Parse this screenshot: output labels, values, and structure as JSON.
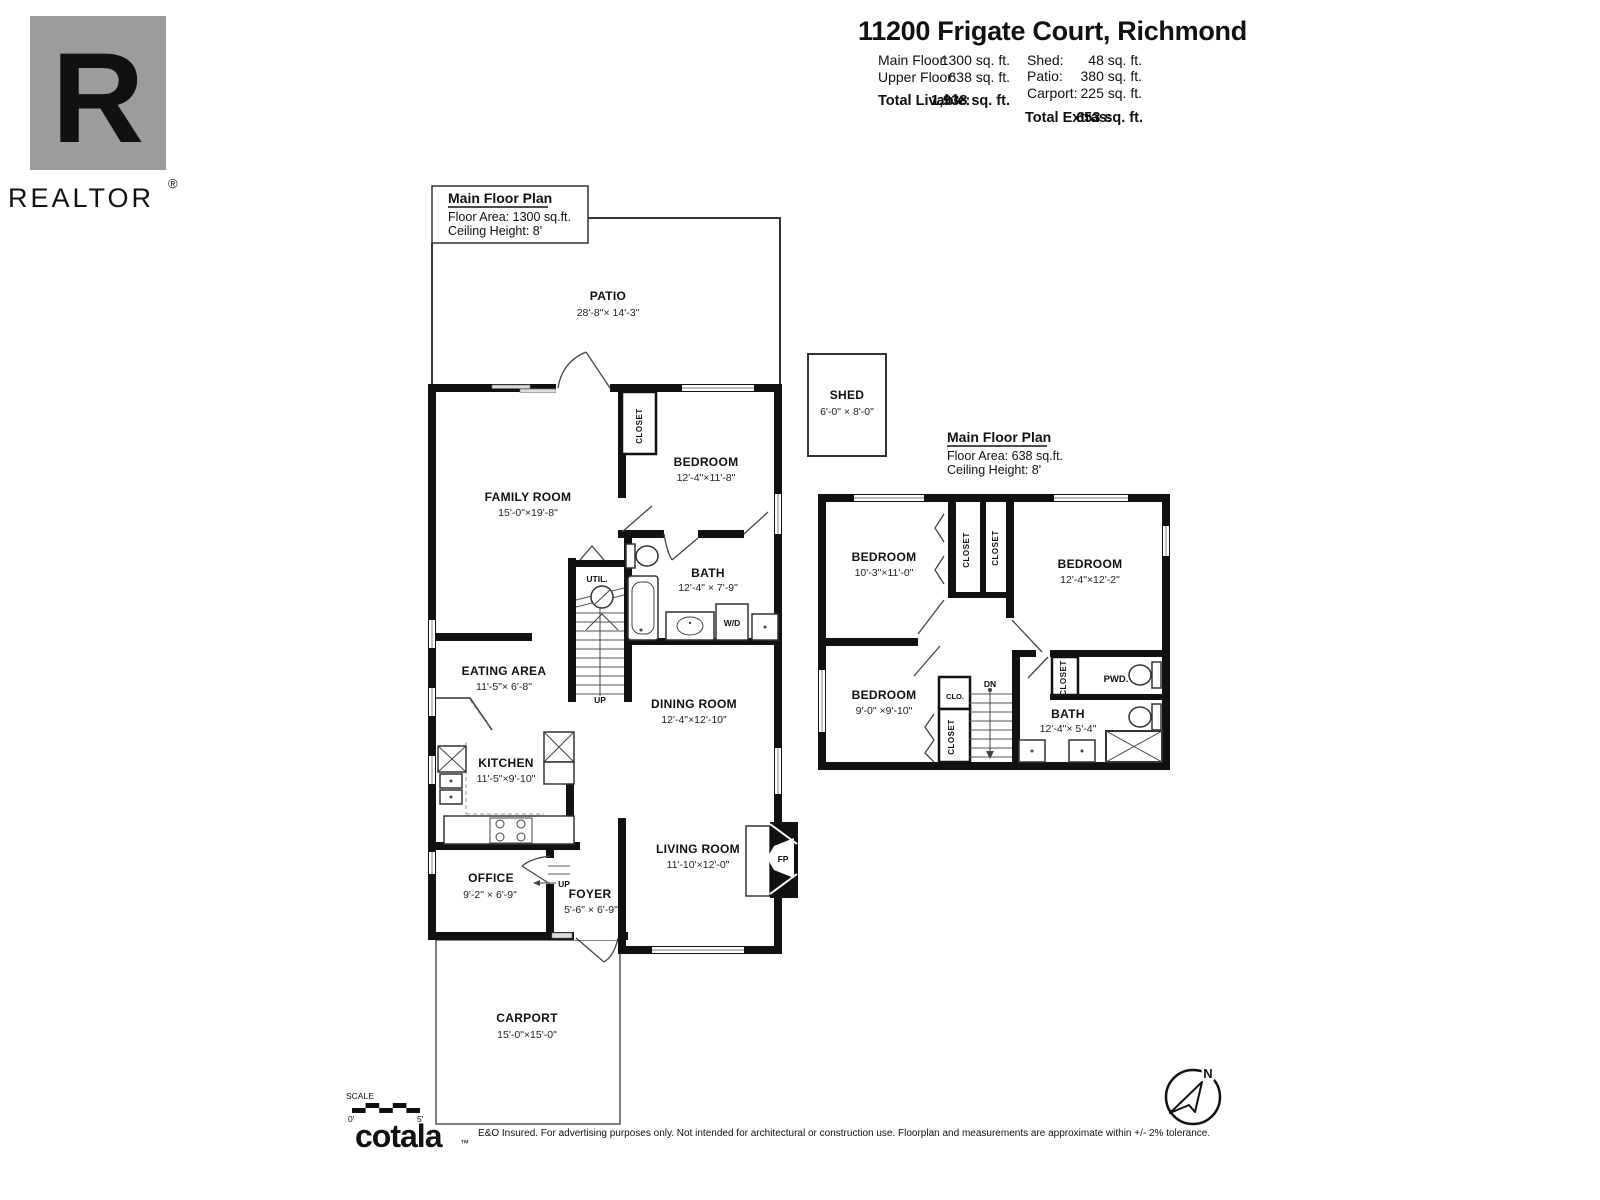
{
  "header": {
    "title": "11200 Frigate Court, Richmond",
    "stats_left": [
      {
        "label": "Main Floor:",
        "value": "1300 sq. ft."
      },
      {
        "label": "Upper Floor:",
        "value": "638 sq. ft."
      }
    ],
    "total_livable": {
      "label": "Total Livable:",
      "value": "1,938 sq. ft."
    },
    "stats_right": [
      {
        "label": "Shed:",
        "value": "48 sq. ft."
      },
      {
        "label": "Patio:",
        "value": "380 sq. ft."
      },
      {
        "label": "Carport:",
        "value": "225 sq. ft."
      }
    ],
    "total_extras": {
      "label": "Total Extras:",
      "value": "653 sq. ft."
    }
  },
  "branding": {
    "realtor_r": "R",
    "realtor": "REALTOR",
    "registered": "®",
    "cotala": "cotala",
    "trademark": "™",
    "disclaimer": "E&O Insured. For advertising purposes only. Not intended for architectural or construction use. Floorplan and measurements are approximate within +/- 2% tolerance."
  },
  "main_plan": {
    "title": "Main Floor Plan",
    "floor_area": "Floor Area: 1300 sq.ft.",
    "ceiling_height": "Ceiling Height: 8'",
    "rooms": {
      "patio": {
        "name": "PATIO",
        "dims": "28'-8\"× 14'-3\""
      },
      "family_room": {
        "name": "FAMILY ROOM",
        "dims": "15'-0\"×19'-8\""
      },
      "bedroom": {
        "name": "BEDROOM",
        "dims": "12'-4\"×11'-8\""
      },
      "closet": {
        "name": "CLOSET"
      },
      "bath": {
        "name": "BATH",
        "dims": "12'-4\" × 7'-9\""
      },
      "util": {
        "name": "UTIL."
      },
      "wd": {
        "name": "W/D"
      },
      "eating_area": {
        "name": "EATING AREA",
        "dims": "11'-5\"× 6'-8\""
      },
      "dining_room": {
        "name": "DINING ROOM",
        "dims": "12'-4\"×12'-10\""
      },
      "kitchen": {
        "name": "KITCHEN",
        "dims": "11'-5\"×9'-10\""
      },
      "living_room": {
        "name": "LIVING ROOM",
        "dims": "11'-10'×12'-0\""
      },
      "office": {
        "name": "OFFICE",
        "dims": "9'-2\" × 6'-9\""
      },
      "foyer": {
        "name": "FOYER",
        "dims": "5'-6\" × 6'-9\""
      },
      "carport": {
        "name": "CARPORT",
        "dims": "15'-0\"×15'-0\""
      },
      "shed": {
        "name": "SHED",
        "dims": "6'-0\" × 8'-0\""
      },
      "fireplace": "FP",
      "stairs_up": "UP",
      "foyer_up": "UP"
    }
  },
  "upper_plan": {
    "title": "Main Floor Plan",
    "floor_area": "Floor Area: 638 sq.ft.",
    "ceiling_height": "Ceiling Height: 8'",
    "rooms": {
      "bedroom1": {
        "name": "BEDROOM",
        "dims": "10'-3\"×11'-0\""
      },
      "bedroom2": {
        "name": "BEDROOM",
        "dims": "12'-4\"×12'-2\""
      },
      "bedroom3": {
        "name": "BEDROOM",
        "dims": "9'-0\" ×9'-10\""
      },
      "closet1": {
        "name": "CLOSET"
      },
      "closet2": {
        "name": "CLOSET"
      },
      "closet3": {
        "name": "CLOSET"
      },
      "closet4": {
        "name": "CLOSET"
      },
      "clo": {
        "name": "CLO."
      },
      "pwd": {
        "name": "PWD."
      },
      "bath": {
        "name": "BATH",
        "dims": "12'-4\"× 5'-4\""
      },
      "stairs_dn": "DN"
    }
  },
  "scale_bar": {
    "label": "SCALE",
    "start": "0'",
    "end": "5'"
  },
  "compass": {
    "north": "N"
  }
}
